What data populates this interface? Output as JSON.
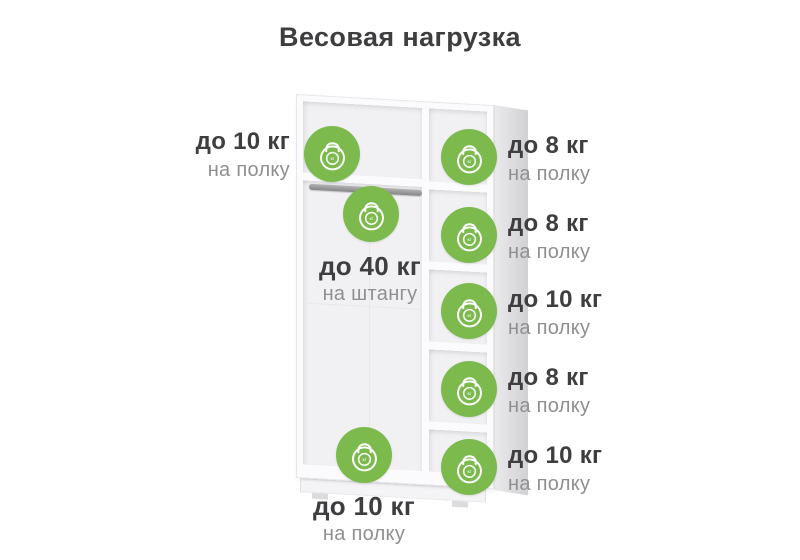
{
  "title": "Весовая нагрузка",
  "colors": {
    "accent_green": "#7cba4e",
    "text_dark": "#3e3e40",
    "text_muted": "#8f8f92"
  },
  "kettlebell": {
    "label": "кг"
  },
  "labels": {
    "top_left": {
      "weight": "до 10 кг",
      "target": "на полку"
    },
    "rod": {
      "weight": "до 40 кг",
      "target": "на штангу"
    },
    "bottom": {
      "weight": "до 10 кг",
      "target": "на полку"
    },
    "right": [
      {
        "weight": "до 8 кг",
        "target": "на полку"
      },
      {
        "weight": "до 8 кг",
        "target": "на полку"
      },
      {
        "weight": "до 10 кг",
        "target": "на полку"
      },
      {
        "weight": "до 8 кг",
        "target": "на полку"
      },
      {
        "weight": "до 10 кг",
        "target": "на полку"
      }
    ]
  }
}
